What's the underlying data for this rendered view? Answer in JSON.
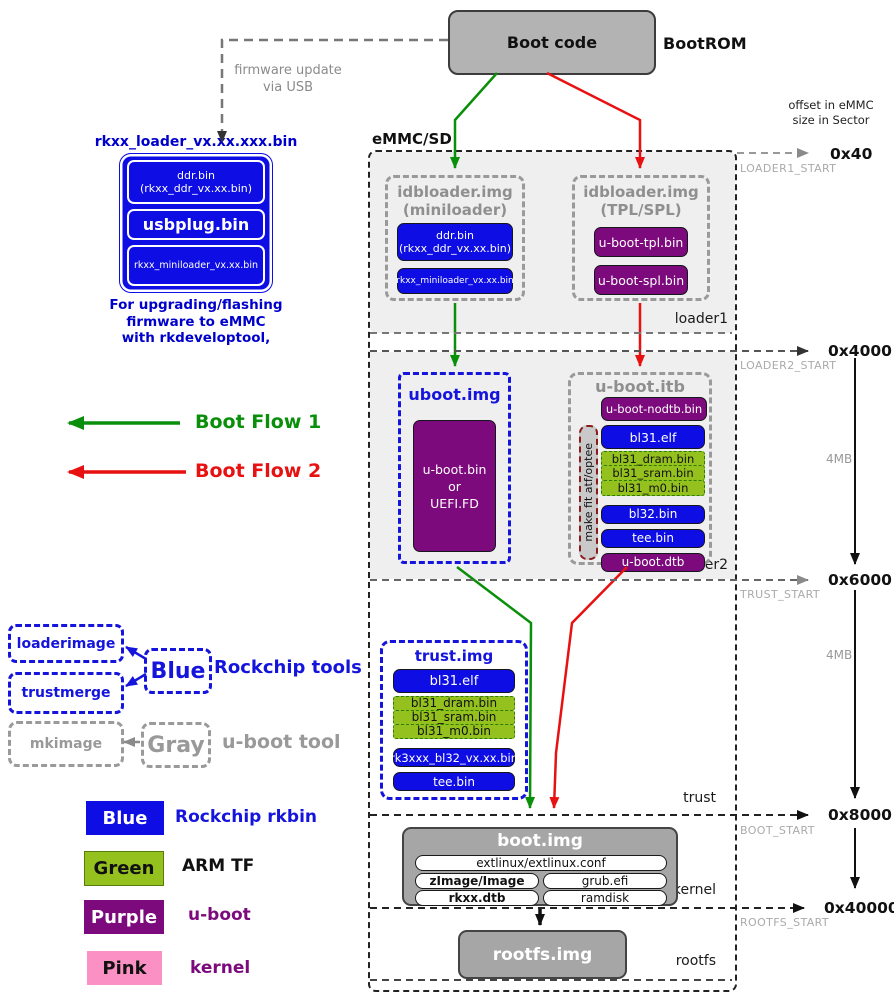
{
  "colors": {
    "blue": "#0d0de4",
    "green": "#95c11f",
    "purple": "#7c0a7c",
    "pink": "#fb90c5",
    "gray": "#b3b3b3",
    "flow1_green": "#0a8f0a",
    "flow2_red": "#e81111"
  },
  "bootrom": {
    "box": "Boot code",
    "label": "BootROM"
  },
  "offset_note": {
    "line1": "offset in eMMC",
    "line2": "size in Sector"
  },
  "usb_note": {
    "line1": "firmware update",
    "line2": "via USB"
  },
  "loader_tool": {
    "title": "rkxx_loader_vx.xx.xxx.bin",
    "ddr_line1": "ddr.bin",
    "ddr_line2": "(rkxx_ddr_vx.xx.bin)",
    "usbplug": "usbplug.bin",
    "miniloader": "rkxx_miniloader_vx.xx.bin",
    "caption1": "For upgrading/flashing",
    "caption2": "firmware to eMMC",
    "caption3": "with rkdeveloptool,"
  },
  "flows": {
    "flow1": "Boot Flow 1",
    "flow2": "Boot Flow 2"
  },
  "tools": {
    "loaderimage": "loaderimage",
    "trustmerge": "trustmerge",
    "blue_box": "Blue",
    "rockchip_tools": "Rockchip tools",
    "mkimage": "mkimage",
    "gray_box": "Gray",
    "uboot_tool": "u-boot tool"
  },
  "legend": [
    {
      "swatch": "Blue",
      "label": "Rockchip rkbin"
    },
    {
      "swatch": "Green",
      "label": "ARM TF"
    },
    {
      "swatch": "Purple",
      "label": "u-boot"
    },
    {
      "swatch": "Pink",
      "label": "kernel"
    }
  ],
  "emmc": {
    "label": "eMMC/SD",
    "loader1": {
      "name": "loader1",
      "mini": {
        "title1": "idbloader.img",
        "title2": "(miniloader)",
        "ddr1": "ddr.bin",
        "ddr2": "(rkxx_ddr_vx.xx.bin)",
        "miniloader": "rkxx_miniloader_vx.xx.bin"
      },
      "tplspl": {
        "title1": "idbloader.img",
        "title2": "(TPL/SPL)",
        "tpl": "u-boot-tpl.bin",
        "spl": "u-boot-spl.bin"
      }
    },
    "loader2": {
      "name": "loader2",
      "ubootimg": {
        "title": "uboot.img",
        "body1": "u-boot.bin",
        "body2": "or",
        "body3": "UEFI.FD"
      },
      "ubootitb": {
        "title": "u-boot.itb",
        "nodtb": "u-boot-nodtb.bin",
        "makefit": "make fit atf/optee",
        "bl31elf": "bl31.elf",
        "dram": "bl31_dram.bin",
        "sram": "bl31_sram.bin",
        "m0": "bl31_m0.bin",
        "bl32": "bl32.bin",
        "tee": "tee.bin",
        "dtb": "u-boot.dtb"
      }
    },
    "trust": {
      "name": "trust",
      "title": "trust.img",
      "bl31elf": "bl31.elf",
      "dram": "bl31_dram.bin",
      "sram": "bl31_sram.bin",
      "m0": "bl31_m0.bin",
      "bl32": "rk3xxx_bl32_vx.xx.bin",
      "tee": "tee.bin"
    },
    "kernel": {
      "name": "kernel",
      "title": "boot.img",
      "extlinux": "extlinux/extlinux.conf",
      "zimage": "zImage/Image",
      "grub": "grub.efi",
      "dtb": "rkxx.dtb",
      "ramdisk": "ramdisk"
    },
    "rootfs": {
      "name": "rootfs",
      "title": "rootfs.img"
    }
  },
  "offsets": [
    {
      "value": "0x40",
      "start": "LOADER1_START"
    },
    {
      "value": "0x4000",
      "start": "LOADER2_START"
    },
    {
      "value": "0x6000",
      "start": "TRUST_START"
    },
    {
      "value": "0x8000",
      "start": "BOOT_START"
    },
    {
      "value": "0x40000",
      "start": "ROOTFS_START"
    }
  ],
  "sizes": {
    "seg1": "4MB",
    "seg2": "4MB"
  }
}
